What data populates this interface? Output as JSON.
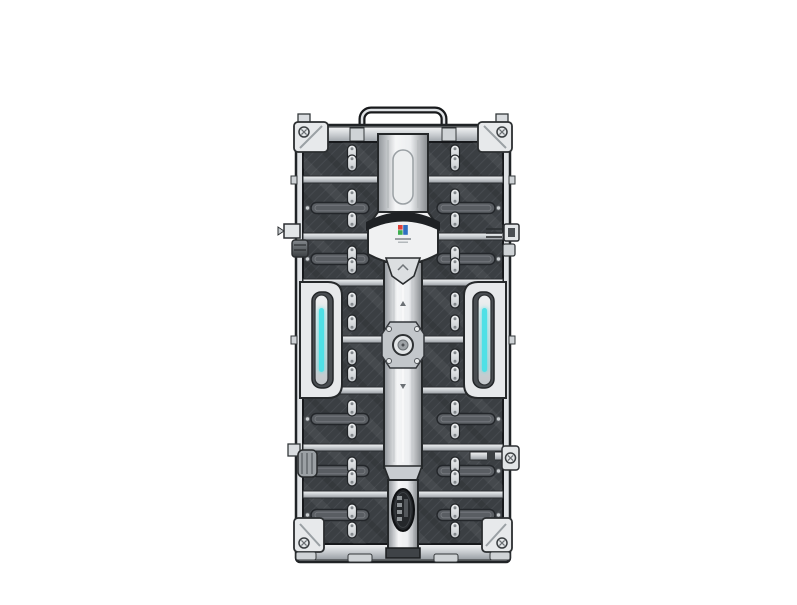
{
  "image": {
    "subject": "Rear view of a modular LED display panel cabinet with carbon-fiber module bays, central spine, carry handle and cyan status LED side handles",
    "background": "#ffffff"
  },
  "colors": {
    "accent_led": "#4fe0e6",
    "frame_light": "#e7e9eb",
    "frame_mid": "#c6cacd",
    "module_dark": "#3b3f43",
    "outline": "#202326",
    "logo_red": "#e04038",
    "logo_green": "#3cae4e",
    "logo_blue": "#2f6fc0"
  }
}
